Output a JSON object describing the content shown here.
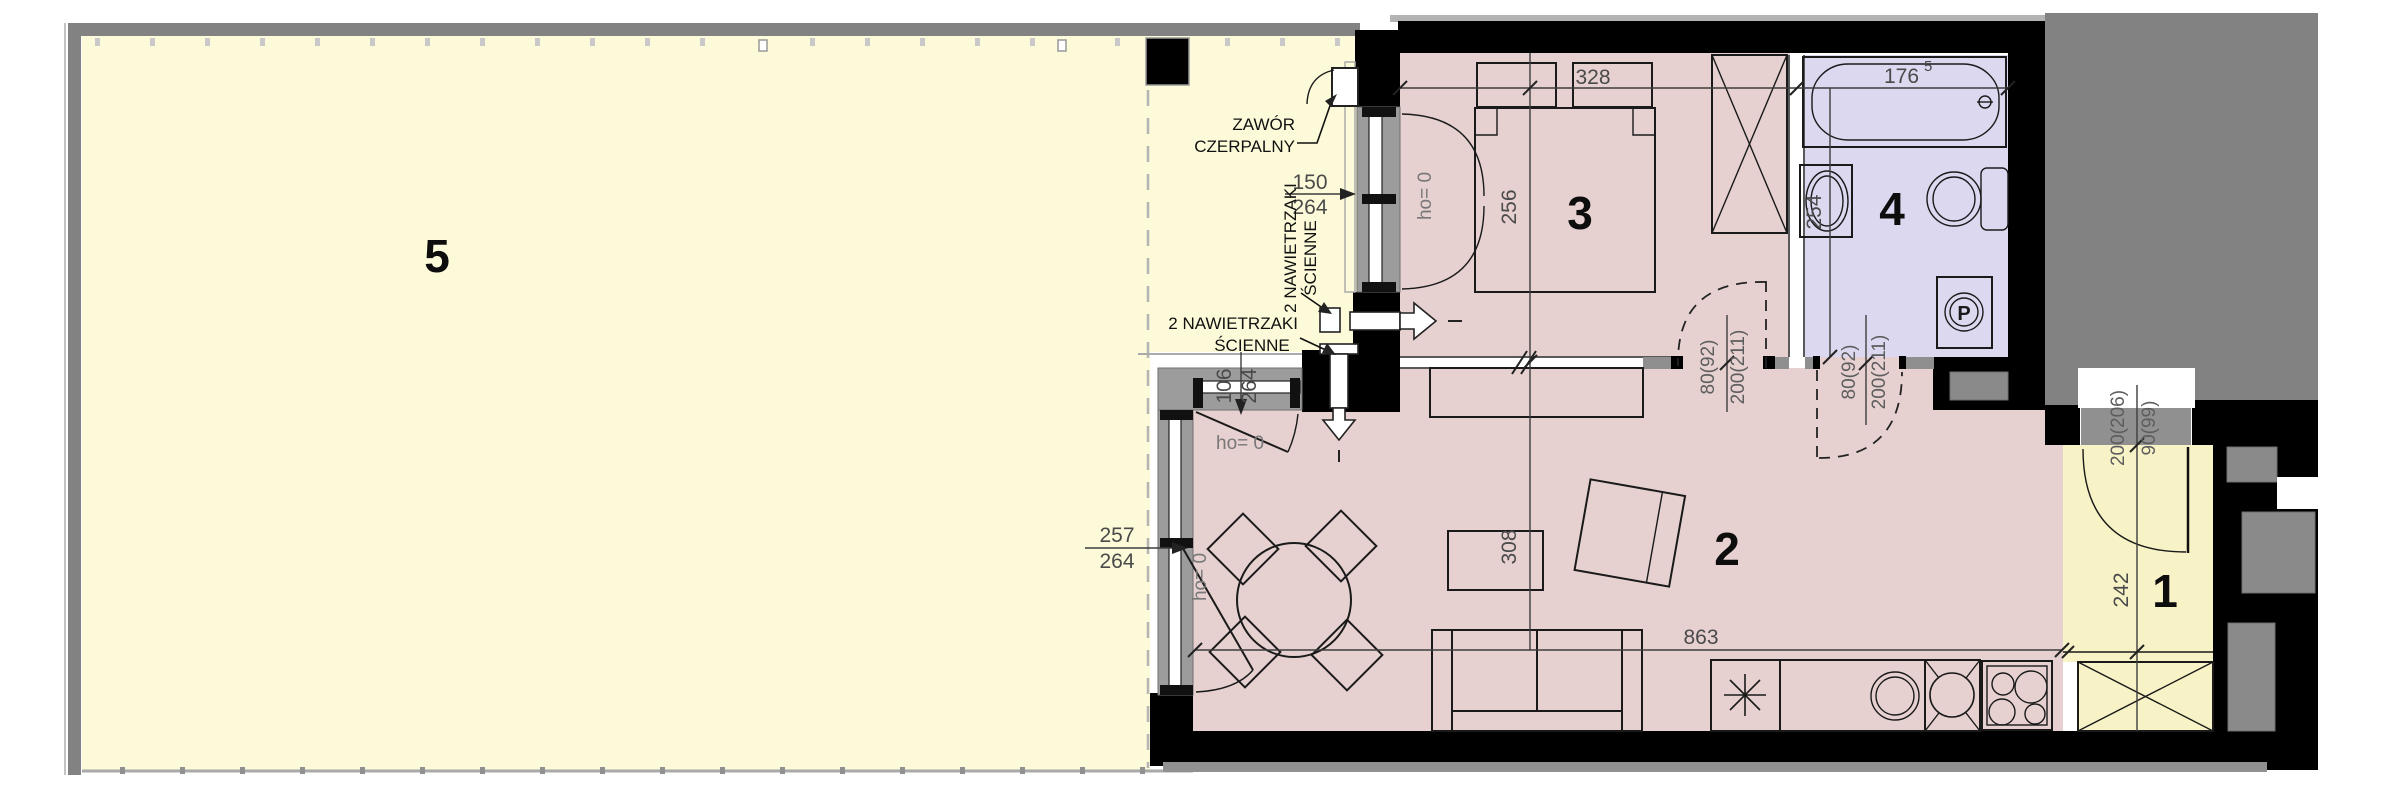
{
  "plan": {
    "rooms": {
      "r1": "1",
      "r2": "2",
      "r3": "3",
      "r4": "4",
      "r5": "5"
    },
    "dims": {
      "bed_w": "328",
      "bed_d": "256",
      "bedwin_w": "150",
      "bedwin_h": "264",
      "bath_w": "176",
      "bath_w_sup": "5",
      "bath_d": "254",
      "cwin_w": "106",
      "cwin_h": "264",
      "tdoor_w": "257",
      "tdoor_h": "264",
      "liv_w": "863",
      "liv_d": "308",
      "hall_d": "242",
      "bed_door_w": "80(92)",
      "bed_door_h": "200(211)",
      "bath_door_w": "80(92)",
      "bath_door_h": "200(211)",
      "entry_door_w": "90(99)",
      "entry_door_h": "200(206)"
    },
    "labels": {
      "valve1": "ZAWÓR",
      "valve2": "CZERPALNY",
      "vent_line1": "2 NAWIETRZAKI",
      "vent_line2": "ŚCIENNE",
      "ho": "ho= 0",
      "washer": "P"
    },
    "colors": {
      "terrace": "#FCFAD8",
      "hall": "#F8F3C6",
      "living": "#E6D0D0",
      "bath": "#DBD8F0",
      "wall": "#000000",
      "slab": "#828282",
      "frame": "#9C9C9C",
      "dim_text": "#4A4A4A"
    }
  }
}
